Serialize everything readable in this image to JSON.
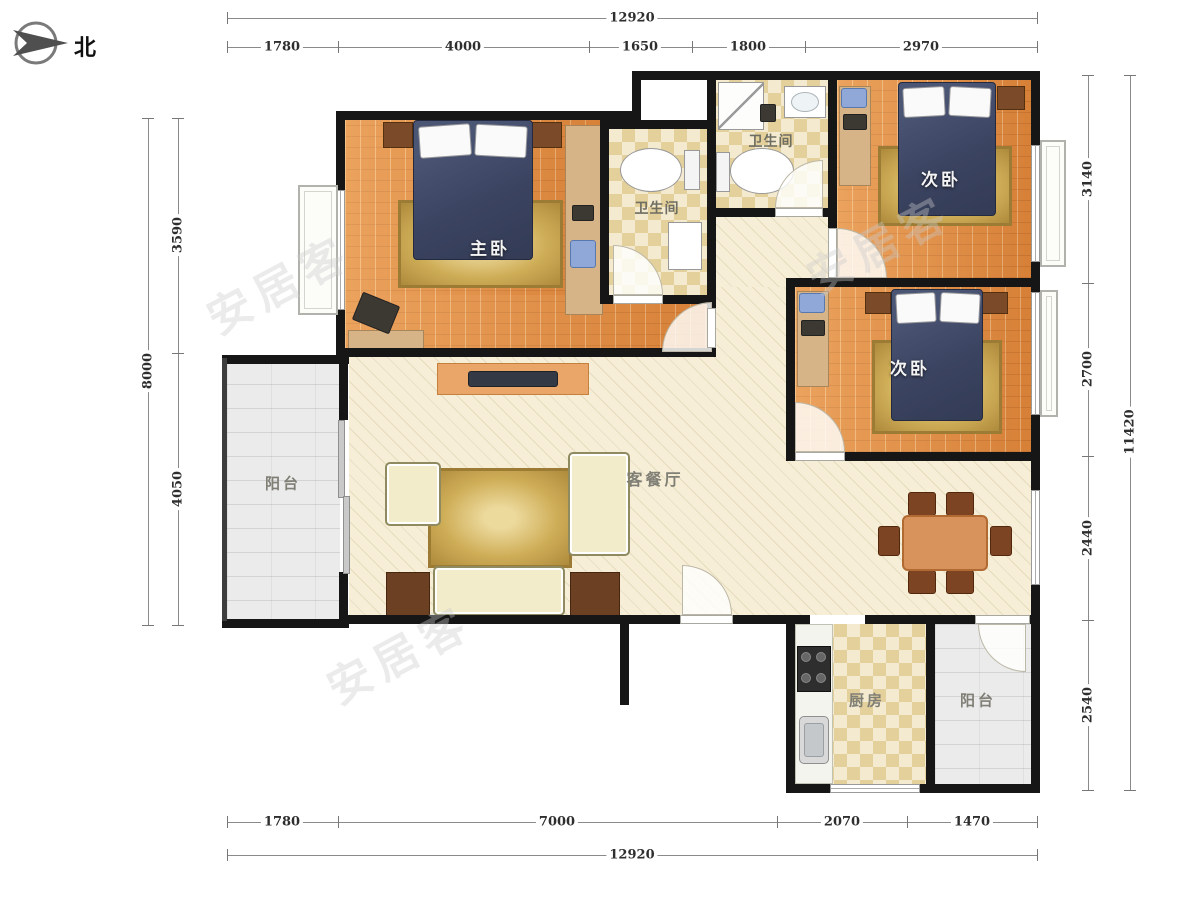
{
  "north": {
    "label": "北"
  },
  "rooms": {
    "master_bedroom": "主卧",
    "second_bedroom": "次卧",
    "bathroom": "卫生间",
    "living_dining": "客餐厅",
    "kitchen": "厨房",
    "balcony": "阳台"
  },
  "dimensions": {
    "top": {
      "total": "12920",
      "segments": [
        "1780",
        "4000",
        "1650",
        "1800",
        "2970"
      ]
    },
    "bottom": {
      "total": "12920",
      "segments": [
        "1780",
        "7000",
        "2070",
        "1470"
      ]
    },
    "left": {
      "total": "8000",
      "segments": [
        "3590",
        "4050"
      ]
    },
    "right": {
      "total": "11420",
      "segments": [
        "3140",
        "2700",
        "2440",
        "2540"
      ]
    }
  },
  "watermark": "安居客",
  "colors": {
    "wall": "#161616",
    "bedroom_floor": "#e0893f",
    "tile_floor": "#f2e7c6",
    "living_floor": "#f6eed6",
    "balcony_floor": "#ebebeb",
    "bed_cover": "#3e4760",
    "rug": "#cfae58",
    "furniture_wood": "#7b4a28"
  }
}
